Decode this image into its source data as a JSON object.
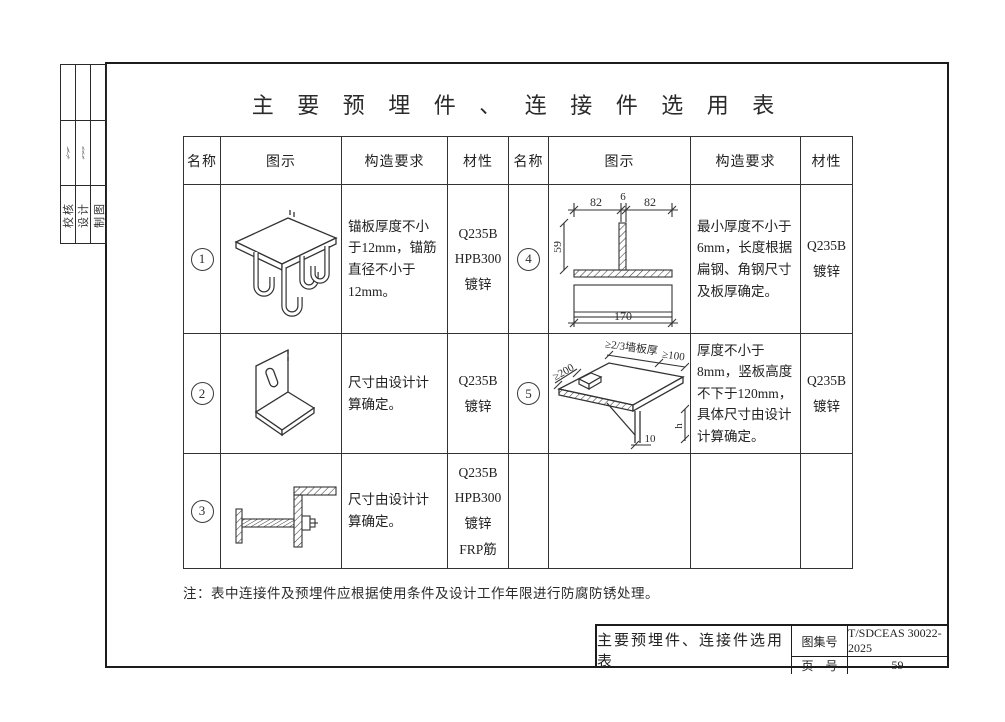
{
  "page": {
    "title": "主 要 预 埋 件 、 连 接 件 选 用 表",
    "note": "注：表中连接件及预埋件应根据使用条件及设计工作年限进行防腐防锈处理。"
  },
  "sidebar": {
    "labels": [
      "校核",
      "设计",
      "制图"
    ]
  },
  "table": {
    "headers": [
      "名称",
      "图示",
      "构造要求",
      "材性"
    ],
    "left_rows": [
      {
        "no": "1",
        "req": "锚板厚度不小于12mm，锚筋直径不小于12mm。",
        "mat": "Q235B\nHPB300\n镀锌"
      },
      {
        "no": "2",
        "req": "尺寸由设计计算确定。",
        "mat": "Q235B\n镀锌"
      },
      {
        "no": "3",
        "req": "尺寸由设计计算确定。",
        "mat": "Q235B\nHPB300\n镀锌\nFRP筋"
      }
    ],
    "right_rows": [
      {
        "no": "4",
        "req": "最小厚度不小于6mm，长度根据扁钢、角钢尺寸及板厚确定。",
        "mat": "Q235B\n镀锌"
      },
      {
        "no": "5",
        "req": "厚度不小于8mm，竖板高度不下于120mm，具体尺寸由设计计算确定。",
        "mat": "Q235B\n镀锌"
      }
    ]
  },
  "diagrams": {
    "d4": {
      "dim_left_82": "82",
      "dim_6": "6",
      "dim_right_82": "82",
      "dim_59": "59",
      "dim_170": "170"
    },
    "d5": {
      "dim_200": "≥200",
      "dim_wall": "≥2/3墙板厚",
      "dim_100": "≥100",
      "dim_h": "h",
      "dim_10": "10"
    }
  },
  "titleblock": {
    "title": "主要预埋件、连接件选用表",
    "atlas_label": "图集号",
    "atlas_value": "T/SDCEAS 30022-2025",
    "page_label": "页　号",
    "page_value": "59"
  }
}
